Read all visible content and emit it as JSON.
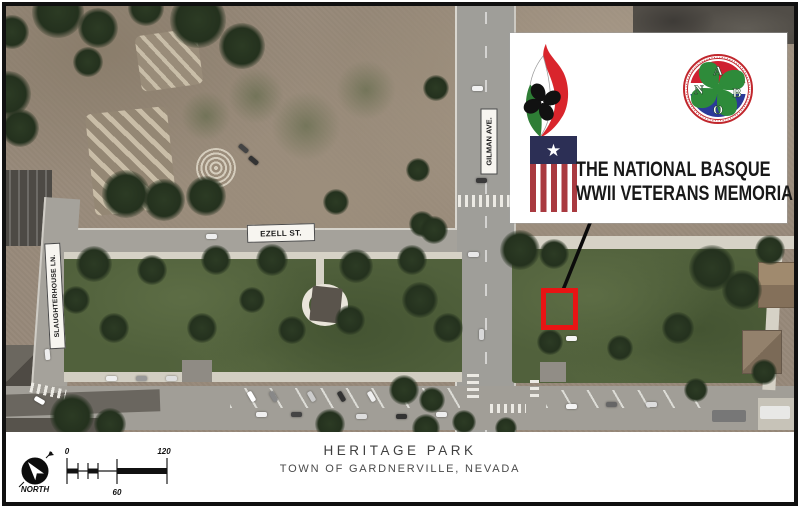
{
  "panel": {
    "title_line1": "THE NATIONAL BASQUE",
    "title_line2": "WWII VETERANS MEMORIAL",
    "nabo": {
      "letter_top": "A",
      "letter_left": "N",
      "letter_right": "B",
      "letter_bottom": "O"
    }
  },
  "map": {
    "labels": {
      "ezell": "EZELL ST.",
      "gilman": "GILMAN AVE.",
      "slaughterhouse": "SLAUGHTERHOUSE LN."
    },
    "marker_color": "#e81414"
  },
  "footer": {
    "north": "NORTH",
    "scale_start": "0",
    "scale_mid": "60",
    "scale_end": "120",
    "park_name": "HERITAGE PARK",
    "location": "TOWN OF GARDNERVILLE, NEVADA"
  },
  "colors": {
    "flame_red": "#d9252c",
    "flame_green": "#2e7d35",
    "flag_navy": "#2c2f55",
    "flag_red": "#a93a40",
    "nabo_red": "#cf2030",
    "nabo_blue": "#2b3a99",
    "nabo_green": "#2e8b3a",
    "grass": "#51613c",
    "dirt": "#97897a"
  }
}
